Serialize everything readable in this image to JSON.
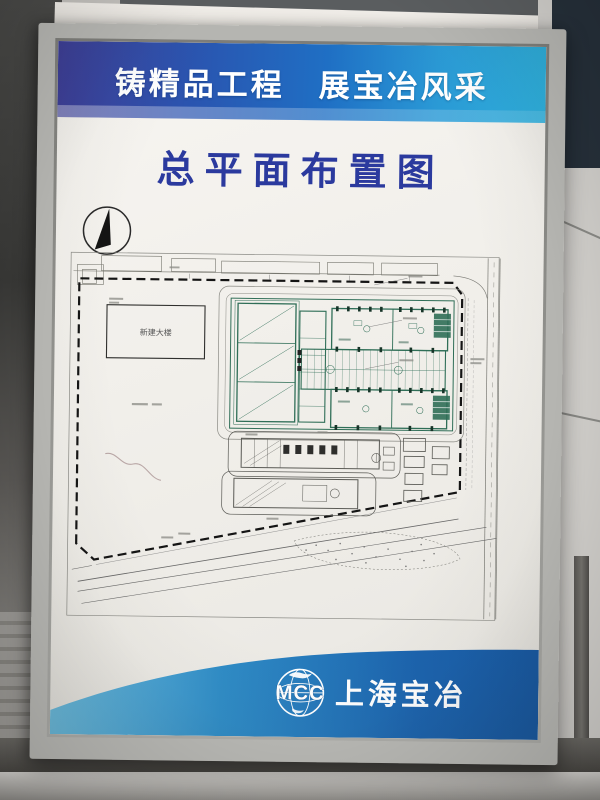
{
  "banner": {
    "slogan": "铸精品工程　展宝冶风采",
    "colors": {
      "left": "#3c3d99",
      "mid": "#1f6fc4",
      "right": "#2cb3e2"
    }
  },
  "title": {
    "text": "总平面布置图",
    "color": "#2b3a9e"
  },
  "plan": {
    "building_label": "新建大楼",
    "building_line_color": "#2f6e57",
    "drawing_line_color": "#5a5a55",
    "boundary_style": "black dashed site red-line"
  },
  "footer": {
    "logo_text": "MCC",
    "company_name": "上海宝冶",
    "band_colors": {
      "left": "#6cc0e4",
      "right": "#1559a6"
    }
  },
  "icons": {
    "north_arrow": "north-arrow-icon",
    "mcc_globe": "mcc-globe-icon"
  }
}
